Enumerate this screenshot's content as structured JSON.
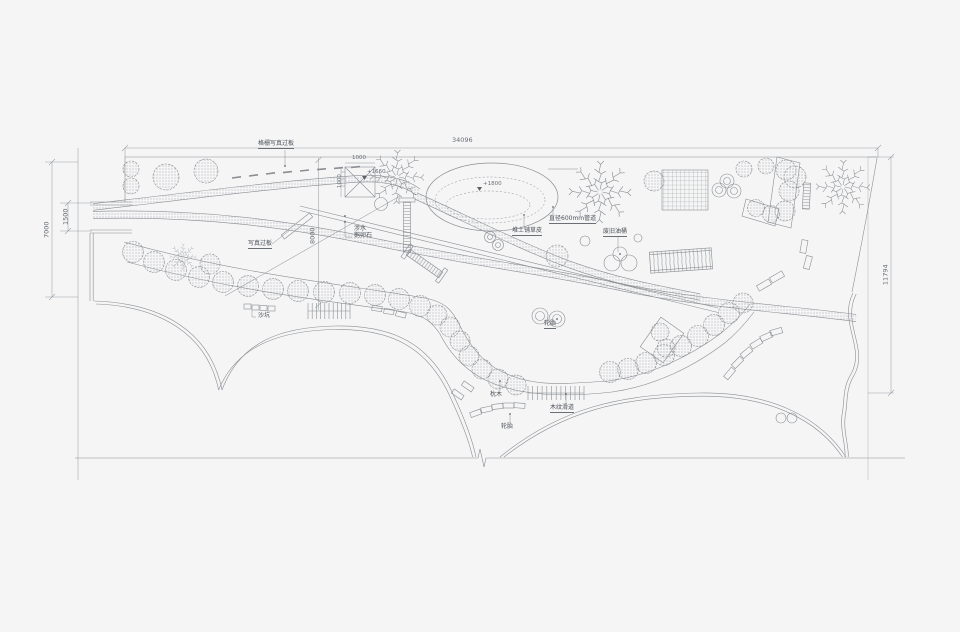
{
  "drawing": {
    "type": "landscape-plan",
    "background": "#f5f5f6",
    "line_color": "#8a8e92",
    "text_color": "#4c5157"
  },
  "dimensions": {
    "site_width": "34096",
    "site_left_height": "7000",
    "entrance_width": "1500",
    "site_right_height": "11794",
    "path_offset": "8000",
    "pavilion_width": "1000",
    "pavilion_depth": "1000"
  },
  "elevations": {
    "platform": "+1660",
    "mound": "+1800"
  },
  "annotations": {
    "grille_board": "格栅写真过板",
    "photo_board": "写真过板",
    "wading": "涉水",
    "pebbles": "鹅卵石",
    "mound_grass": "堆土铺草皮",
    "pipe": "直径600mm管道",
    "oil_drums": "废旧油桶",
    "sand_pit": "沙坑",
    "tires_mid": "轮胎",
    "sleepers": "枕木",
    "tires_bottom": "轮胎",
    "wood_slide": "木纹滑道"
  }
}
